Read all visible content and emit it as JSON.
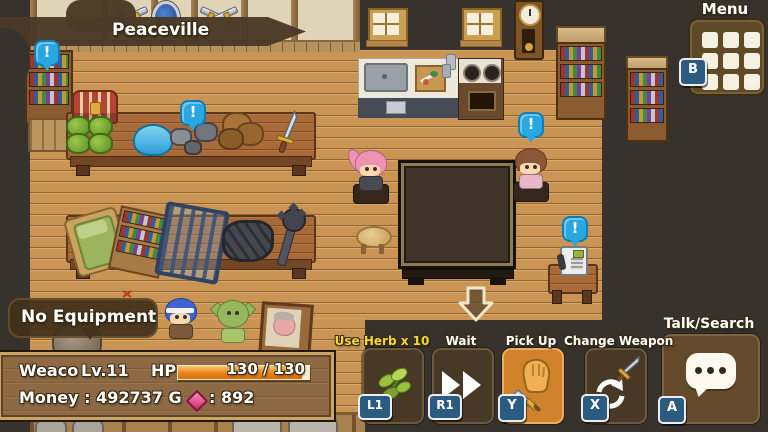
{
  "scene": {
    "location": "Peaceville",
    "indicator": "!",
    "objects": [
      "bookshelf",
      "treasure-chest",
      "cabbage-crate",
      "blue-slime",
      "ore-rocks",
      "dirt-pile",
      "sword",
      "tilted-bed",
      "item-shelf",
      "steel-cage",
      "coal-rubble",
      "mace",
      "kitchen-counter",
      "sink",
      "cutting-board-picture",
      "stove",
      "wall-clock",
      "window",
      "crossed-swords-decor",
      "shield-decor",
      "grand-table",
      "stool",
      "telephone",
      "phone-table",
      "framed-portrait",
      "barrel",
      "exit-arrow"
    ],
    "npcs": [
      "pink-haired-villager",
      "brown-haired-villager",
      "blue-haired-hero",
      "goblin"
    ]
  },
  "hud": {
    "menu": {
      "label": "Menu",
      "key": "B",
      "icon": "menu-grid-icon"
    },
    "equipment_notice": "No Equipment",
    "status": {
      "name": "Weaco",
      "level": "Lv.11",
      "hp_label": "HP",
      "hp_value": "130 / 130",
      "money": "Money : 492737 G",
      "gem_count": ": 892",
      "gem_icon": "pink-gem-icon"
    },
    "actions": [
      {
        "label": "Use Herb x 10",
        "key": "L1",
        "icon": "herb-icon",
        "highlighted": false,
        "label_color": "#f0d838"
      },
      {
        "label": "Wait",
        "key": "R1",
        "icon": "fast-forward-icon",
        "highlighted": false
      },
      {
        "label": "Pick Up",
        "key": "Y",
        "icon": "glove-sword-icon",
        "highlighted": true
      },
      {
        "label": "Change Weapon",
        "key": "X",
        "icon": "swap-weapon-icon",
        "highlighted": false
      },
      {
        "label": "Talk/Search",
        "key": "A",
        "icon": "speech-bubble-icon",
        "highlighted": false
      }
    ]
  },
  "colors": {
    "indicator_blue": "#2aa6e0",
    "action_highlight_orange": "#d0832c",
    "key_badge_blue": "#2b5c80",
    "hp_bar_orange": "#ee8a20",
    "herb_label_yellow": "#f0d838",
    "floor_wood": "#c99454",
    "panel_border_tan": "#caa464",
    "banner_brown": "#4a3a26"
  }
}
